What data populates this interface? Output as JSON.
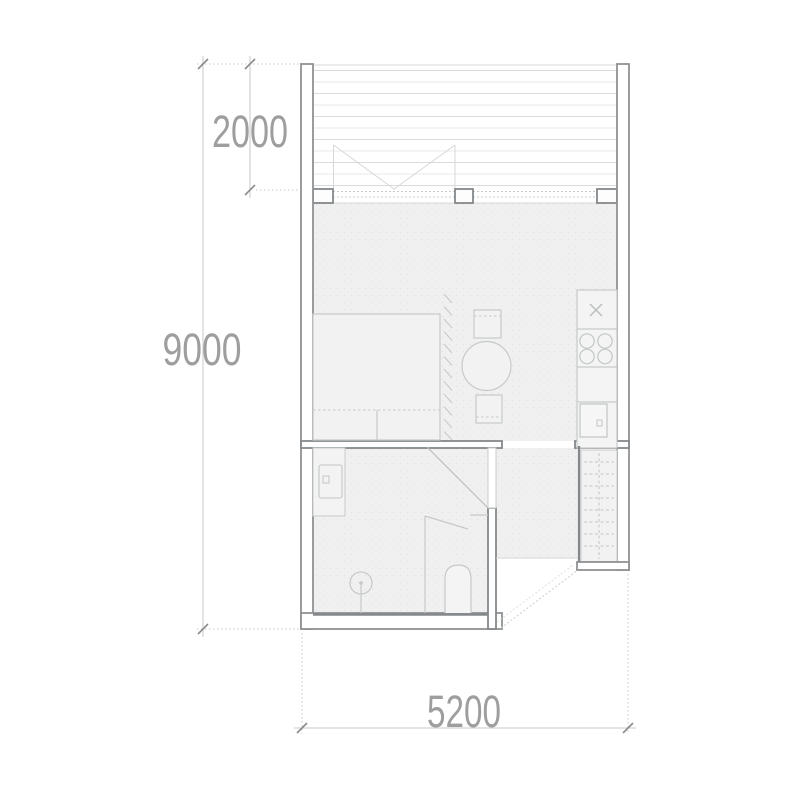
{
  "floor_plan": {
    "type": "architectural-floor-plan",
    "dimensions": {
      "terrace_depth": "2000",
      "overall_length": "9000",
      "overall_width": "5200"
    },
    "colors": {
      "background": "#ffffff",
      "wall_stroke": "#8f9193",
      "interior_wall_stroke": "#85888a",
      "furniture_stroke": "#c7caca",
      "furniture_fill": "#f2f2f3",
      "floor_fill": "#f0f0f1",
      "deck_line_dark": "#dbdbdb",
      "deck_line_light": "#eaeaea",
      "glazing_line": "#c9cccc",
      "dimension_line": "#c8c8c8",
      "dimension_tick": "#8a8a8a",
      "dimension_text": "#9e9e9e"
    }
  }
}
